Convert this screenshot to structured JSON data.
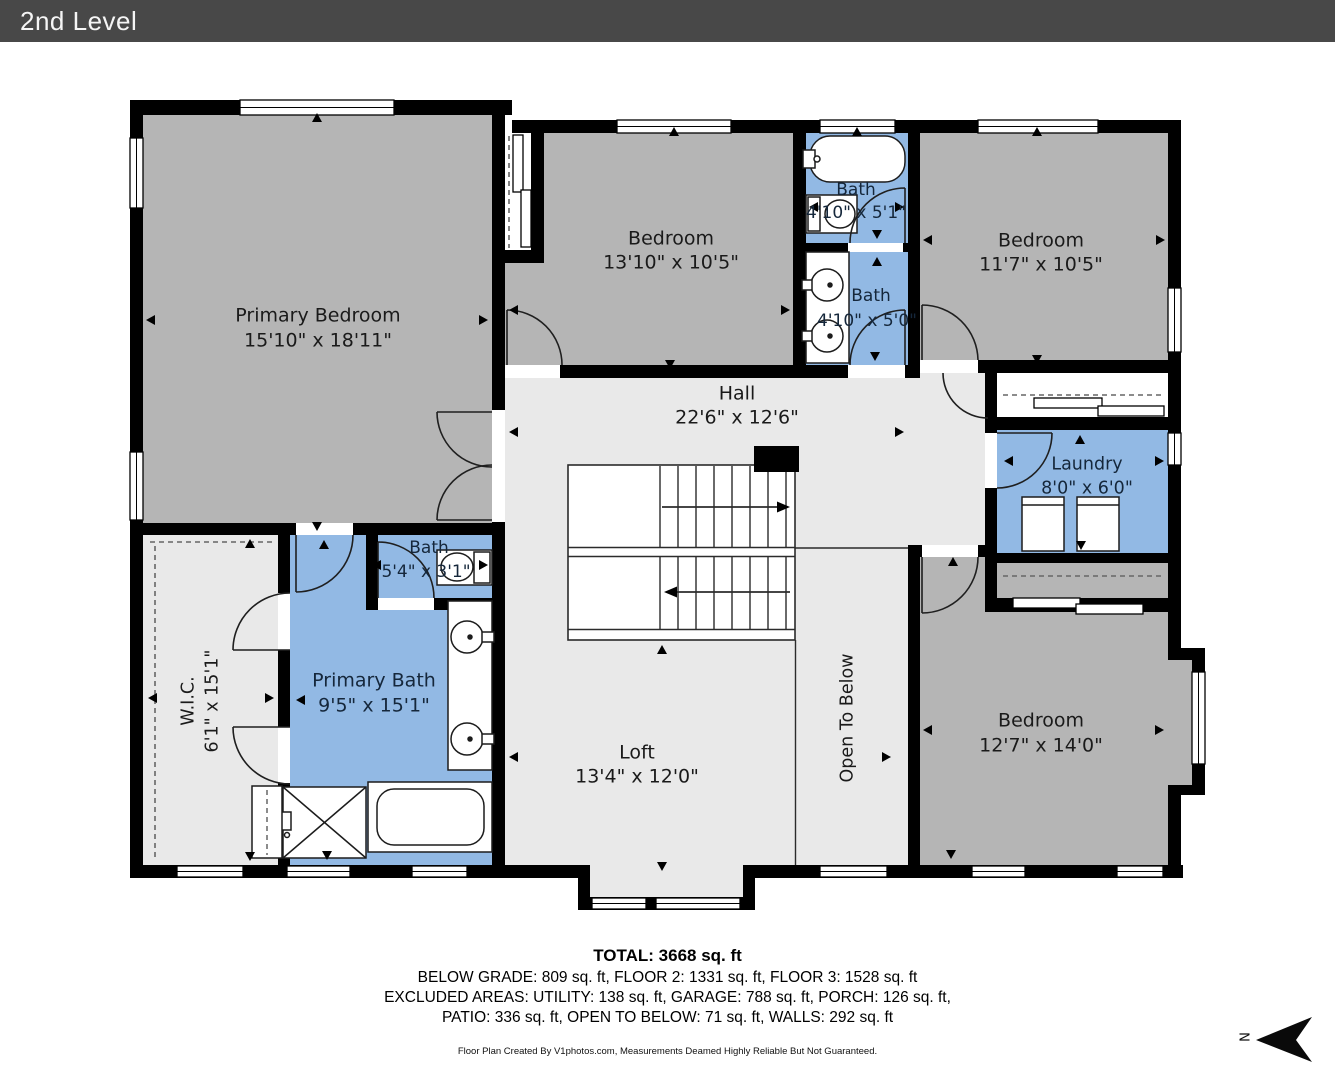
{
  "header": {
    "title": "2nd Level"
  },
  "colors": {
    "header_bg": "#484848",
    "wall": "#000000",
    "bedroom_fill": "#b5b5b5",
    "hall_fill": "#e9e9e9",
    "bath_fill": "#92b9e4"
  },
  "rooms": {
    "primary_bedroom": {
      "name": "Primary Bedroom",
      "dims": "15'10\" x 18'11\""
    },
    "bedroom_top": {
      "name": "Bedroom",
      "dims": "13'10\" x 10'5\""
    },
    "bath_upper": {
      "name": "Bath",
      "dims": "4'10\" x 5'1\""
    },
    "bath_lower": {
      "name": "Bath",
      "dims": "4'10\" x 5'0\""
    },
    "bedroom_right": {
      "name": "Bedroom",
      "dims": "11'7\" x 10'5\""
    },
    "hall": {
      "name": "Hall",
      "dims": "22'6\" x 12'6\""
    },
    "laundry": {
      "name": "Laundry",
      "dims": "8'0\" x 6'0\""
    },
    "wic": {
      "name": "W.I.C.",
      "dims": "6'1\" x 15'1\""
    },
    "bath_small": {
      "name": "Bath",
      "dims": "5'4\" x 3'1\""
    },
    "primary_bath": {
      "name": "Primary Bath",
      "dims": "9'5\" x 15'1\""
    },
    "loft": {
      "name": "Loft",
      "dims": "13'4\" x 12'0\""
    },
    "open_to_below": {
      "name": "Open To Below"
    },
    "bedroom_bottom": {
      "name": "Bedroom",
      "dims": "12'7\" x 14'0\""
    }
  },
  "summary": {
    "total": "TOTAL: 3668 sq. ft",
    "line1": "BELOW GRADE: 809 sq. ft, FLOOR 2: 1331 sq. ft, FLOOR 3: 1528 sq. ft",
    "line2": "EXCLUDED AREAS: UTILITY: 138 sq. ft, GARAGE: 788 sq. ft, PORCH: 126 sq. ft,",
    "line3": "PATIO: 336 sq. ft, OPEN TO BELOW: 71 sq. ft, WALLS: 292 sq. ft"
  },
  "footer": {
    "credit": "Floor Plan Created By V1photos.com, Measurements Deamed Highly Reliable But Not Guaranteed."
  },
  "compass": {
    "label": "N"
  }
}
